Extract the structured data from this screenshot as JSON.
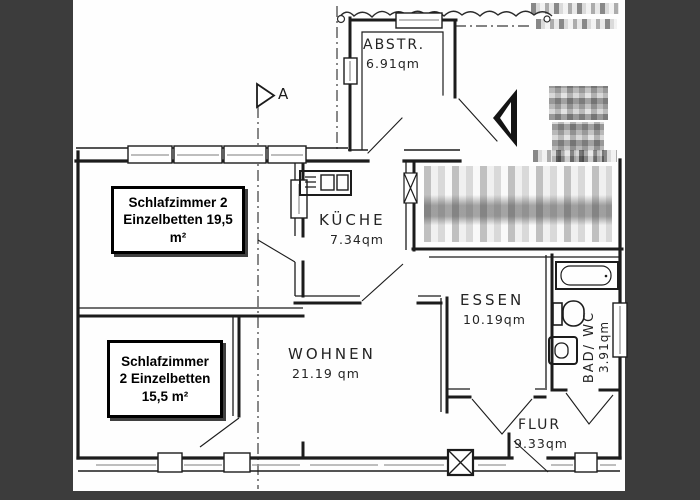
{
  "colors": {
    "surround": "#3c3c3c",
    "paper": "#fefefe",
    "wall": "#1c1c1c"
  },
  "rooms": {
    "abstr": {
      "name": "ABSTR.",
      "area": "6.91qm"
    },
    "kueche": {
      "name": "KÜCHE",
      "area": "7.34qm"
    },
    "wohnen": {
      "name": "WOHNEN",
      "area": "21.19 qm"
    },
    "essen": {
      "name": "ESSEN",
      "area": "10.19qm"
    },
    "bad": {
      "name": "BAD/ WC",
      "area": "3.91qm"
    },
    "flur": {
      "name": "FLUR",
      "area": "9.33qm"
    }
  },
  "annotations": {
    "bedroom1": {
      "line1": "Schlafzimmer 2",
      "line2": "Einzelbetten 19,5",
      "line3": "m²"
    },
    "bedroom2": {
      "line1": "Schlafzimmer",
      "line2": "2 Einzelbetten",
      "line3": "15,5 m²"
    }
  },
  "markers": {
    "section_label": "A"
  },
  "icons": [
    "section-marker-icon",
    "door-icon",
    "door-x-icon",
    "kitchen-sink-icon",
    "bathtub-icon",
    "toilet-icon",
    "sink-icon",
    "shaft-icon",
    "redacted-mosaic",
    "property-line",
    "section-line"
  ]
}
